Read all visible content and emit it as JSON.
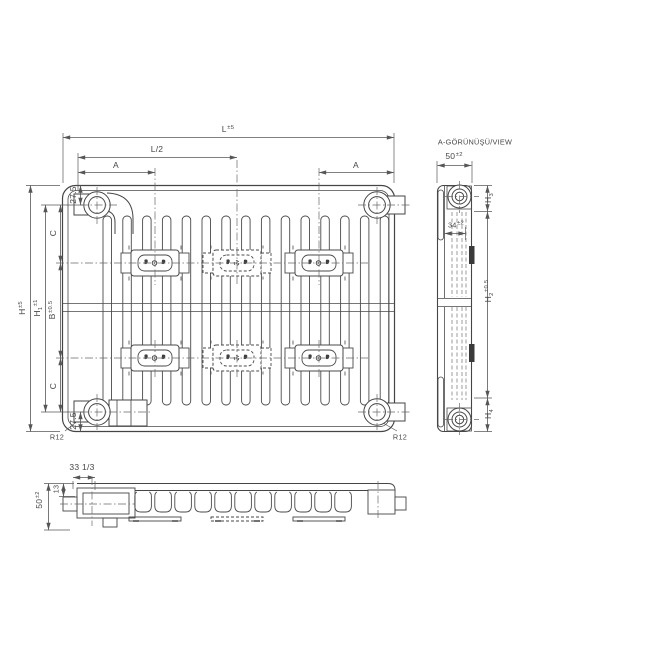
{
  "front_view": {
    "dims": {
      "length": {
        "base": "L",
        "tol": "±5"
      },
      "half_length": {
        "base": "L/2"
      },
      "a_left": {
        "base": "A"
      },
      "a_right": {
        "base": "A"
      },
      "height": {
        "base": "H",
        "tol": "±5"
      },
      "h1": {
        "base": "H",
        "sub": "1",
        "tol": "±1"
      },
      "bracket_span": {
        "base": "B",
        "tol": "±0.5"
      },
      "c_top": {
        "base": "C"
      },
      "c_bottom": {
        "base": "C"
      },
      "edge_top": {
        "base": "27.5"
      },
      "edge_bottom": {
        "base": "27.5"
      },
      "radius_left": {
        "base": "R12"
      },
      "radius_right": {
        "base": "R12"
      }
    }
  },
  "side_view": {
    "title": "A-GÖRÜNÜŞÜ/VIEW",
    "dims": {
      "depth": {
        "base": "50",
        "tol": "±2"
      },
      "inner_offset": {
        "base": "34",
        "tol": "±2"
      },
      "h3": {
        "base": "H",
        "sub": "3"
      },
      "h2": {
        "base": "H",
        "sub": "2",
        "tol": "±0.5"
      },
      "h4": {
        "base": "H",
        "sub": "4"
      }
    }
  },
  "bottom_view": {
    "dims": {
      "fin_pitch": {
        "base": "33 1/3"
      },
      "top_offset": {
        "base": "13"
      },
      "depth": {
        "base": "50",
        "tol": "±2"
      }
    }
  }
}
